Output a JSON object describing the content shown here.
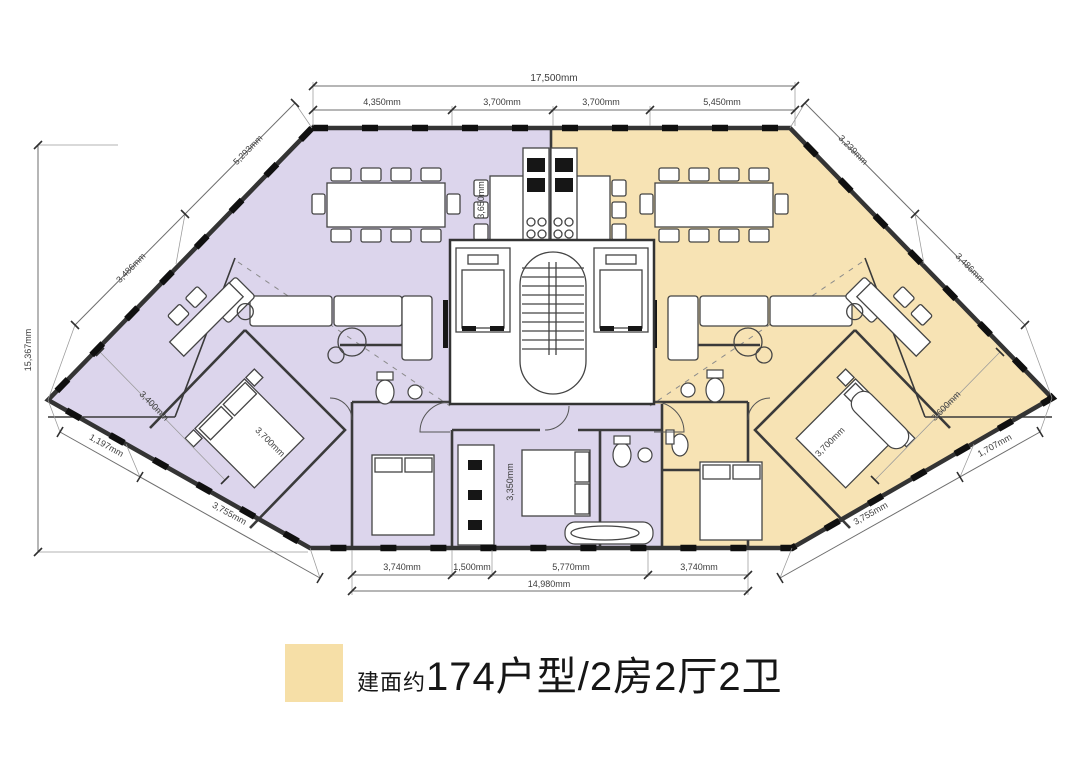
{
  "legend": {
    "swatch_color": "#f6dfa7",
    "prefix": "建面约",
    "title": "174户型/2房2厅2卫"
  },
  "plan": {
    "unit_left_color": "#dcd5ec",
    "unit_right_color": "#f7e3b4",
    "wall_color": "#343434",
    "background": "#ffffff"
  },
  "dimensions": {
    "top_overall": "17,500mm",
    "top_segments": [
      "4,350mm",
      "3,700mm",
      "3,700mm",
      "5,450mm"
    ],
    "bottom_segments": [
      "3,740mm",
      "1,500mm",
      "5,770mm",
      "3,740mm"
    ],
    "bottom_overall": "14,980mm",
    "left_vertical": "15,367mm",
    "upper_left_diagonal": [
      "5,293mm",
      "3,486mm"
    ],
    "upper_right_diagonal": [
      "3,239mm",
      "3,486mm"
    ],
    "lower_left_diagonal": [
      "1,197mm",
      "3,755mm"
    ],
    "lower_right_diagonal": [
      "1,707mm",
      "3,755mm"
    ],
    "right_inner_diagonal": "3,600mm",
    "left_inner_diagonal": "3,400mm",
    "interior": [
      "3,650mm",
      "3,700mm",
      "3,350mm",
      "3,700mm"
    ]
  }
}
